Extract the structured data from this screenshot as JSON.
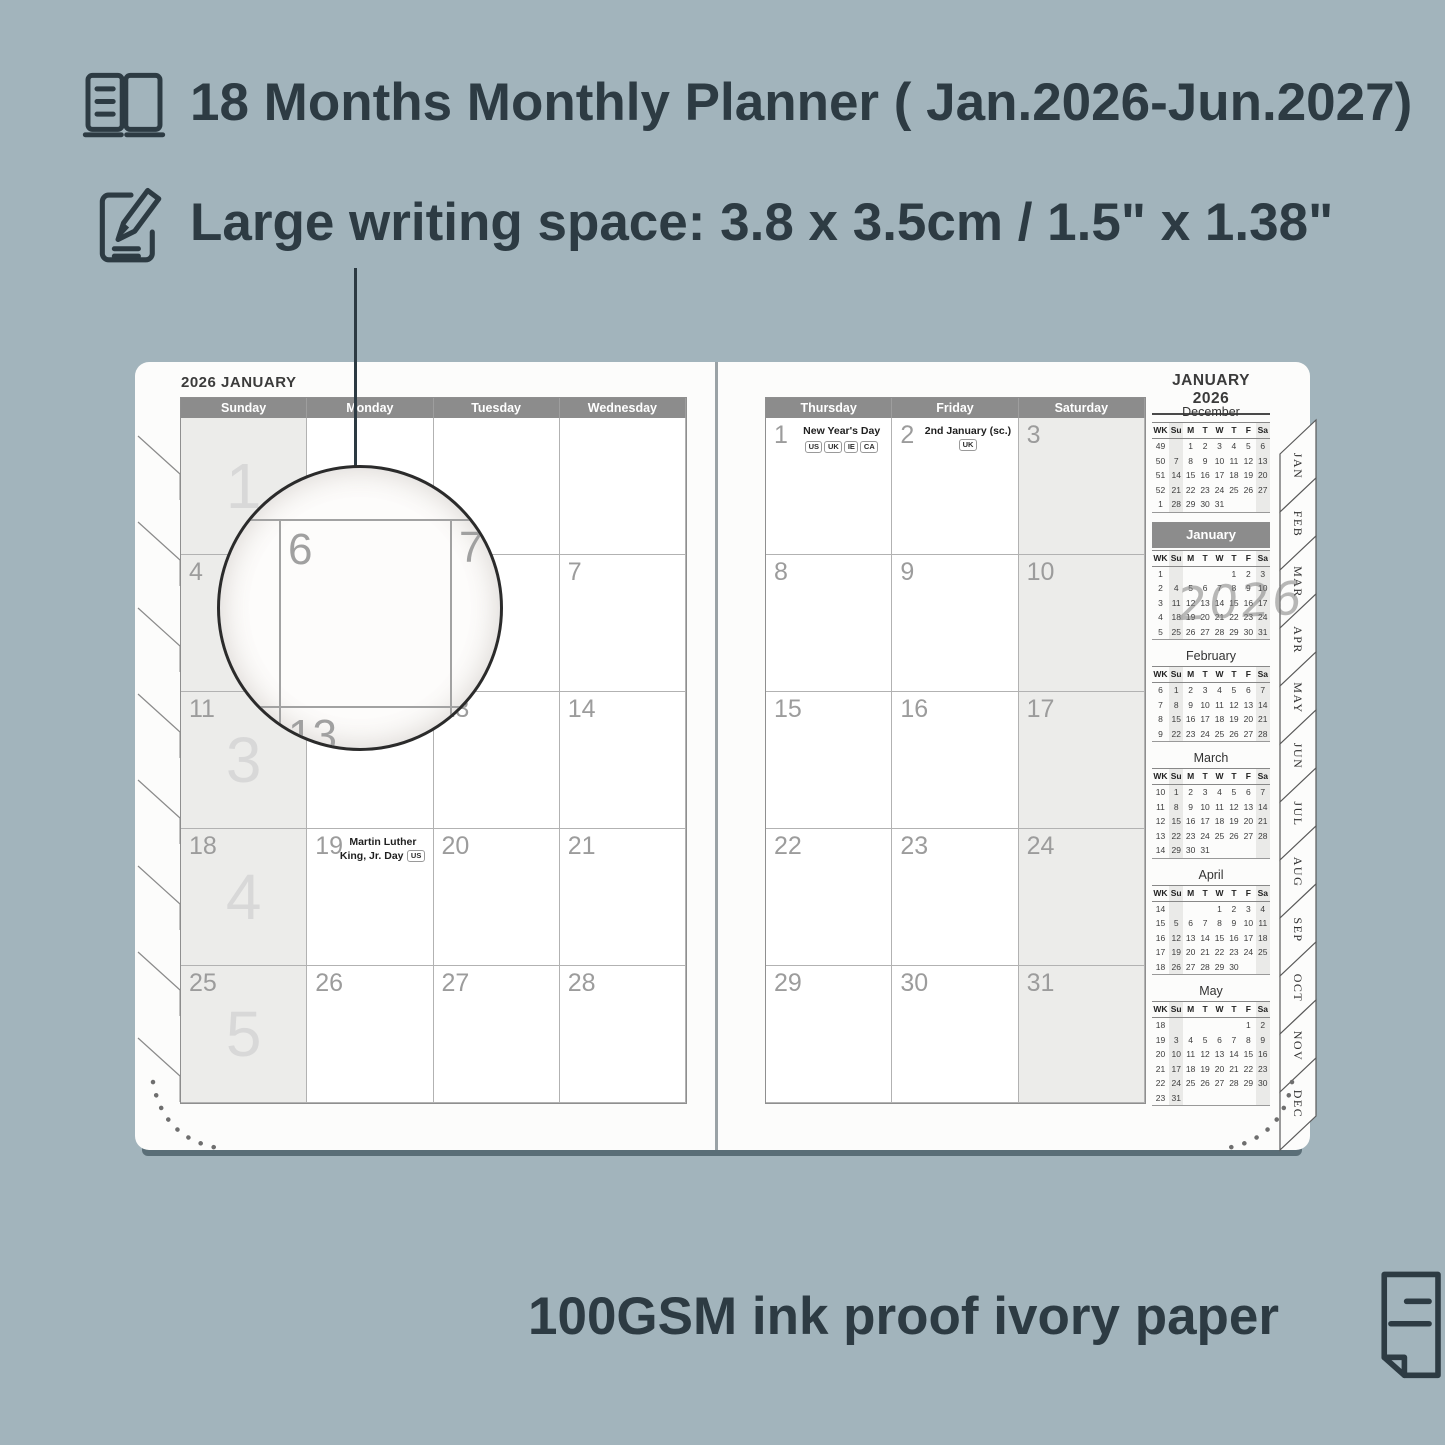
{
  "features": {
    "planner_range": "18 Months Monthly Planner ( Jan.2026-Jun.2027)",
    "writing_space": "Large writing space: 3.8 x 3.5cm / 1.5\" x 1.38\"",
    "paper": "100GSM ink proof ivory paper"
  },
  "colors": {
    "background": "#a2b4bc",
    "text_dark": "#2d3b43",
    "header_gray": "#8c8c8c",
    "cell_shade": "#ececea",
    "page": "#fcfcfb"
  },
  "planner": {
    "left_title": "2026 JANUARY",
    "right_title": "JANUARY 2026",
    "left_day_headers": [
      "Sunday",
      "Monday",
      "Tuesday",
      "Wednesday"
    ],
    "right_day_headers": [
      "Thursday",
      "Friday",
      "Saturday"
    ],
    "left_weeks": [
      {
        "week_number": "1",
        "days": [
          {
            "date": ""
          },
          {
            "date": ""
          },
          {
            "date": ""
          },
          {
            "date": ""
          }
        ]
      },
      {
        "week_number": "2",
        "days": [
          {
            "date": "4"
          },
          {
            "date": "5"
          },
          {
            "date": "6"
          },
          {
            "date": "7"
          }
        ]
      },
      {
        "week_number": "3",
        "days": [
          {
            "date": "11"
          },
          {
            "date": "12"
          },
          {
            "date": "13"
          },
          {
            "date": "14"
          }
        ]
      },
      {
        "week_number": "4",
        "days": [
          {
            "date": "18"
          },
          {
            "date": "19",
            "holiday": "Martin Luther King, Jr. Day",
            "badges": [
              "US"
            ],
            "layout": "inline"
          },
          {
            "date": "20"
          },
          {
            "date": "21"
          }
        ]
      },
      {
        "week_number": "5",
        "days": [
          {
            "date": "25"
          },
          {
            "date": "26"
          },
          {
            "date": "27"
          },
          {
            "date": "28"
          }
        ]
      }
    ],
    "right_weeks": [
      {
        "days": [
          {
            "date": "1",
            "holiday": "New Year's Day",
            "badges": [
              "US",
              "UK",
              "IE",
              "CA"
            ],
            "layout": "stack"
          },
          {
            "date": "2",
            "holiday": "2nd January (sc.)",
            "badges": [
              "UK"
            ],
            "layout": "inline"
          },
          {
            "date": "3"
          }
        ]
      },
      {
        "days": [
          {
            "date": "8"
          },
          {
            "date": "9"
          },
          {
            "date": "10"
          }
        ]
      },
      {
        "days": [
          {
            "date": "15"
          },
          {
            "date": "16"
          },
          {
            "date": "17"
          }
        ]
      },
      {
        "days": [
          {
            "date": "22"
          },
          {
            "date": "23"
          },
          {
            "date": "24"
          }
        ]
      },
      {
        "days": [
          {
            "date": "29"
          },
          {
            "date": "30"
          },
          {
            "date": "31"
          }
        ]
      }
    ],
    "magnifier_numbers": {
      "top_left": "6",
      "top_right": "7",
      "bottom_left": "13"
    },
    "watermark": "2026",
    "sidebar": {
      "mini_header": [
        "WK",
        "Su",
        "M",
        "T",
        "W",
        "T",
        "F",
        "Sa"
      ],
      "months": [
        {
          "name": "December",
          "active": false,
          "rows": [
            [
              "49",
              "",
              "1",
              "2",
              "3",
              "4",
              "5",
              "6"
            ],
            [
              "50",
              "7",
              "8",
              "9",
              "10",
              "11",
              "12",
              "13"
            ],
            [
              "51",
              "14",
              "15",
              "16",
              "17",
              "18",
              "19",
              "20"
            ],
            [
              "52",
              "21",
              "22",
              "23",
              "24",
              "25",
              "26",
              "27"
            ],
            [
              "1",
              "28",
              "29",
              "30",
              "31",
              "",
              "",
              ""
            ]
          ]
        },
        {
          "name": "January",
          "active": true,
          "rows": [
            [
              "1",
              "",
              "",
              "",
              "",
              "1",
              "2",
              "3"
            ],
            [
              "2",
              "4",
              "5",
              "6",
              "7",
              "8",
              "9",
              "10"
            ],
            [
              "3",
              "11",
              "12",
              "13",
              "14",
              "15",
              "16",
              "17"
            ],
            [
              "4",
              "18",
              "19",
              "20",
              "21",
              "22",
              "23",
              "24"
            ],
            [
              "5",
              "25",
              "26",
              "27",
              "28",
              "29",
              "30",
              "31"
            ]
          ]
        },
        {
          "name": "February",
          "active": false,
          "rows": [
            [
              "6",
              "1",
              "2",
              "3",
              "4",
              "5",
              "6",
              "7"
            ],
            [
              "7",
              "8",
              "9",
              "10",
              "11",
              "12",
              "13",
              "14"
            ],
            [
              "8",
              "15",
              "16",
              "17",
              "18",
              "19",
              "20",
              "21"
            ],
            [
              "9",
              "22",
              "23",
              "24",
              "25",
              "26",
              "27",
              "28"
            ]
          ]
        },
        {
          "name": "March",
          "active": false,
          "rows": [
            [
              "10",
              "1",
              "2",
              "3",
              "4",
              "5",
              "6",
              "7"
            ],
            [
              "11",
              "8",
              "9",
              "10",
              "11",
              "12",
              "13",
              "14"
            ],
            [
              "12",
              "15",
              "16",
              "17",
              "18",
              "19",
              "20",
              "21"
            ],
            [
              "13",
              "22",
              "23",
              "24",
              "25",
              "26",
              "27",
              "28"
            ],
            [
              "14",
              "29",
              "30",
              "31",
              "",
              "",
              "",
              ""
            ]
          ]
        },
        {
          "name": "April",
          "active": false,
          "rows": [
            [
              "14",
              "",
              "",
              "",
              "1",
              "2",
              "3",
              "4"
            ],
            [
              "15",
              "5",
              "6",
              "7",
              "8",
              "9",
              "10",
              "11"
            ],
            [
              "16",
              "12",
              "13",
              "14",
              "15",
              "16",
              "17",
              "18"
            ],
            [
              "17",
              "19",
              "20",
              "21",
              "22",
              "23",
              "24",
              "25"
            ],
            [
              "18",
              "26",
              "27",
              "28",
              "29",
              "30",
              "",
              ""
            ]
          ]
        },
        {
          "name": "May",
          "active": false,
          "rows": [
            [
              "18",
              "",
              "",
              "",
              "",
              "",
              "1",
              "2"
            ],
            [
              "19",
              "3",
              "4",
              "5",
              "6",
              "7",
              "8",
              "9"
            ],
            [
              "20",
              "10",
              "11",
              "12",
              "13",
              "14",
              "15",
              "16"
            ],
            [
              "21",
              "17",
              "18",
              "19",
              "20",
              "21",
              "22",
              "23"
            ],
            [
              "22",
              "24",
              "25",
              "26",
              "27",
              "28",
              "29",
              "30"
            ],
            [
              "23",
              "31",
              "",
              "",
              "",
              "",
              "",
              ""
            ]
          ]
        }
      ]
    },
    "tabs": [
      "JAN",
      "FEB",
      "MAR",
      "APR",
      "MAY",
      "JUN",
      "JUL",
      "AUG",
      "SEP",
      "OCT",
      "NOV",
      "DEC"
    ]
  }
}
